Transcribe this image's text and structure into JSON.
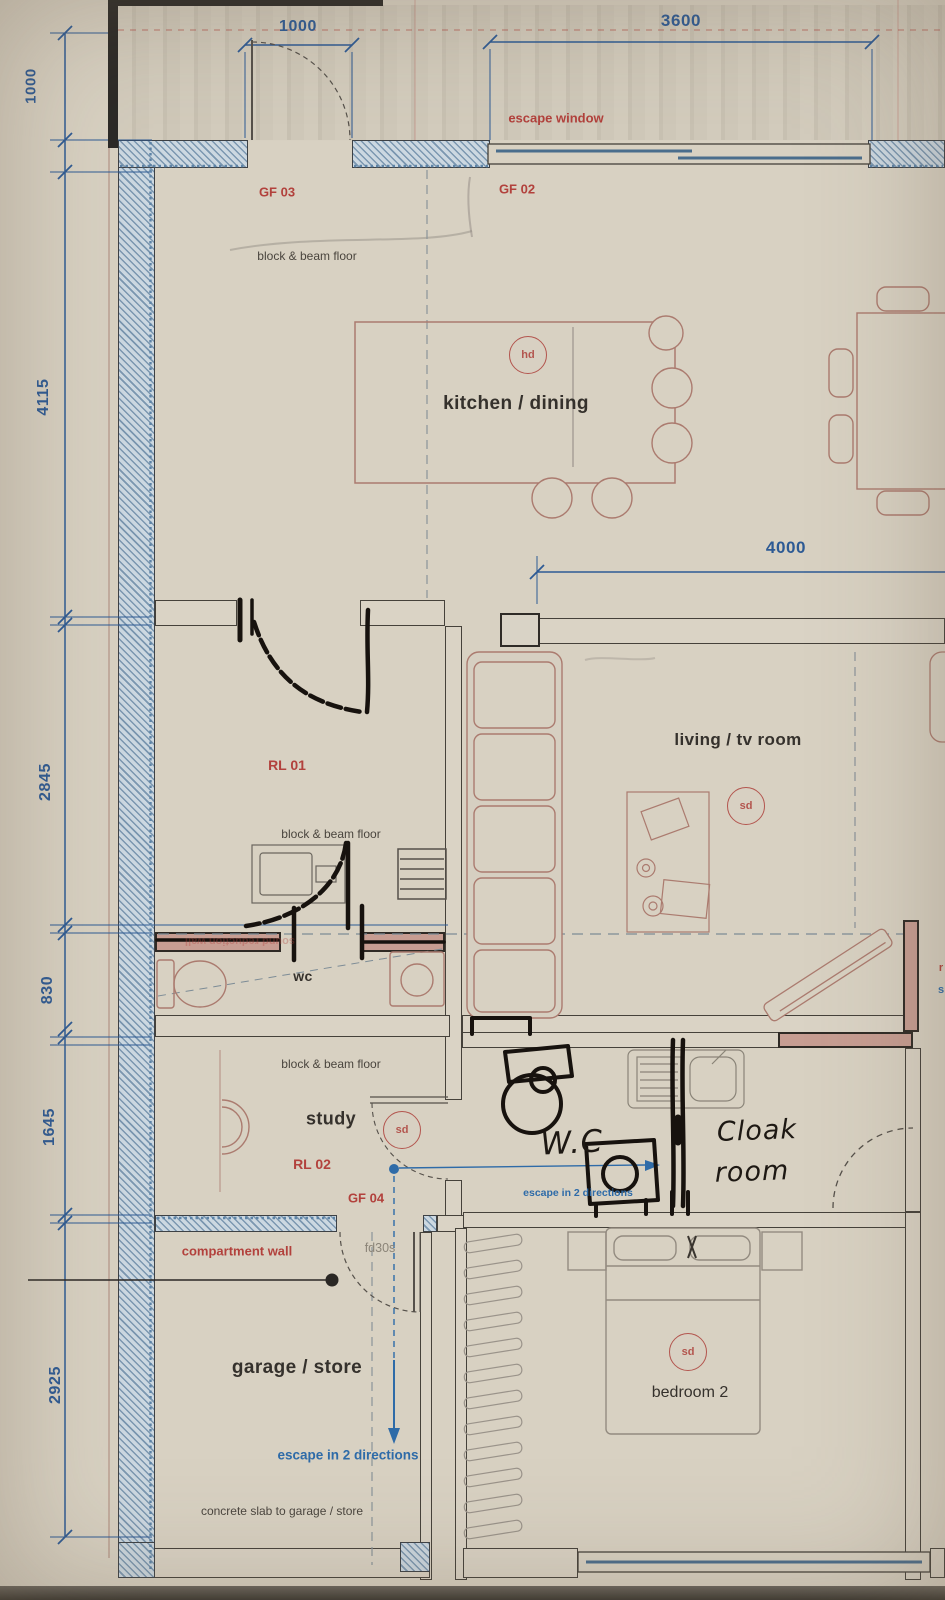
{
  "document": {
    "type": "ground floor plan — photographed architectural drawing"
  },
  "dims": {
    "left": [
      "1000",
      "4115",
      "2845",
      "830",
      "1645",
      "2925"
    ],
    "top": [
      "1000",
      "3600"
    ],
    "living": "4000"
  },
  "rooms": {
    "kitchen_dining": "kitchen / dining",
    "living_tv": "living / tv room",
    "study": "study",
    "garage_store": "garage / store",
    "bedroom2": "bedroom 2",
    "wc": "wc"
  },
  "codes": {
    "gf03": "GF 03",
    "gf02": "GF 02",
    "gf04": "GF 04",
    "rl01": "RL 01",
    "rl02": "RL 02"
  },
  "red_notes": {
    "escape_window": "escape window",
    "compartment_wall": "compartment wall",
    "sound_reduction_wall": "sound reduction wall"
  },
  "notes": {
    "block_beam": "block & beam floor",
    "concrete_slab": "concrete slab to garage / store",
    "fire_door": "fd30s"
  },
  "blue_notes": {
    "escape_two_directions": "escape in 2 directions"
  },
  "handwriting": {
    "wc": "W.C",
    "cloak_line1": "Cloak",
    "cloak_line2": "room"
  },
  "detectors": {
    "heat": "hd",
    "smoke": "sd"
  },
  "edge_text": {
    "right_red": "r",
    "right_blue": "s"
  },
  "colors": {
    "paper": "#d8d1c2",
    "dimension_blue": "#2d5a94",
    "annotation_red": "#b2413c",
    "note_blue": "#2e6ba8",
    "wall_hatch_blue": "#7b97b0",
    "pink_wall": "#c79d92",
    "ink": "#312d28",
    "hand_ink": "#17120e"
  }
}
